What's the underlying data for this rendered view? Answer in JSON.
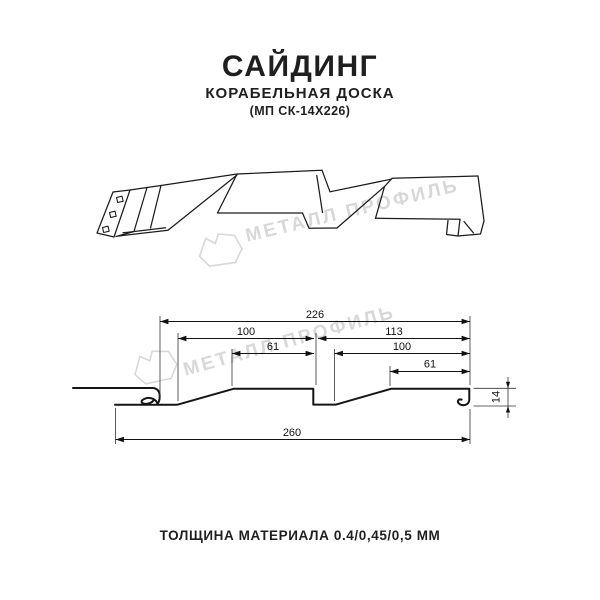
{
  "header": {
    "title": "САЙДИНГ",
    "subtitle": "КОРАБЕЛЬНАЯ ДОСКА",
    "model_code": "(МП СК-14Х226)"
  },
  "watermark": {
    "brand": "МЕТАЛЛ ПРОФИЛЬ",
    "color": "#d8d8d8"
  },
  "drawing": {
    "type": "siding profile technical drawing",
    "dims": {
      "working_width": "226",
      "board1_width": "100",
      "board1_face": "61",
      "board2_width": "113",
      "board2_inner": "100",
      "board2_face": "61",
      "overall_width": "260",
      "profile_height": "14"
    }
  },
  "footer": {
    "thickness": "ТОЛЩИНА МАТЕРИАЛА 0.4/0,45/0,5 ММ"
  }
}
